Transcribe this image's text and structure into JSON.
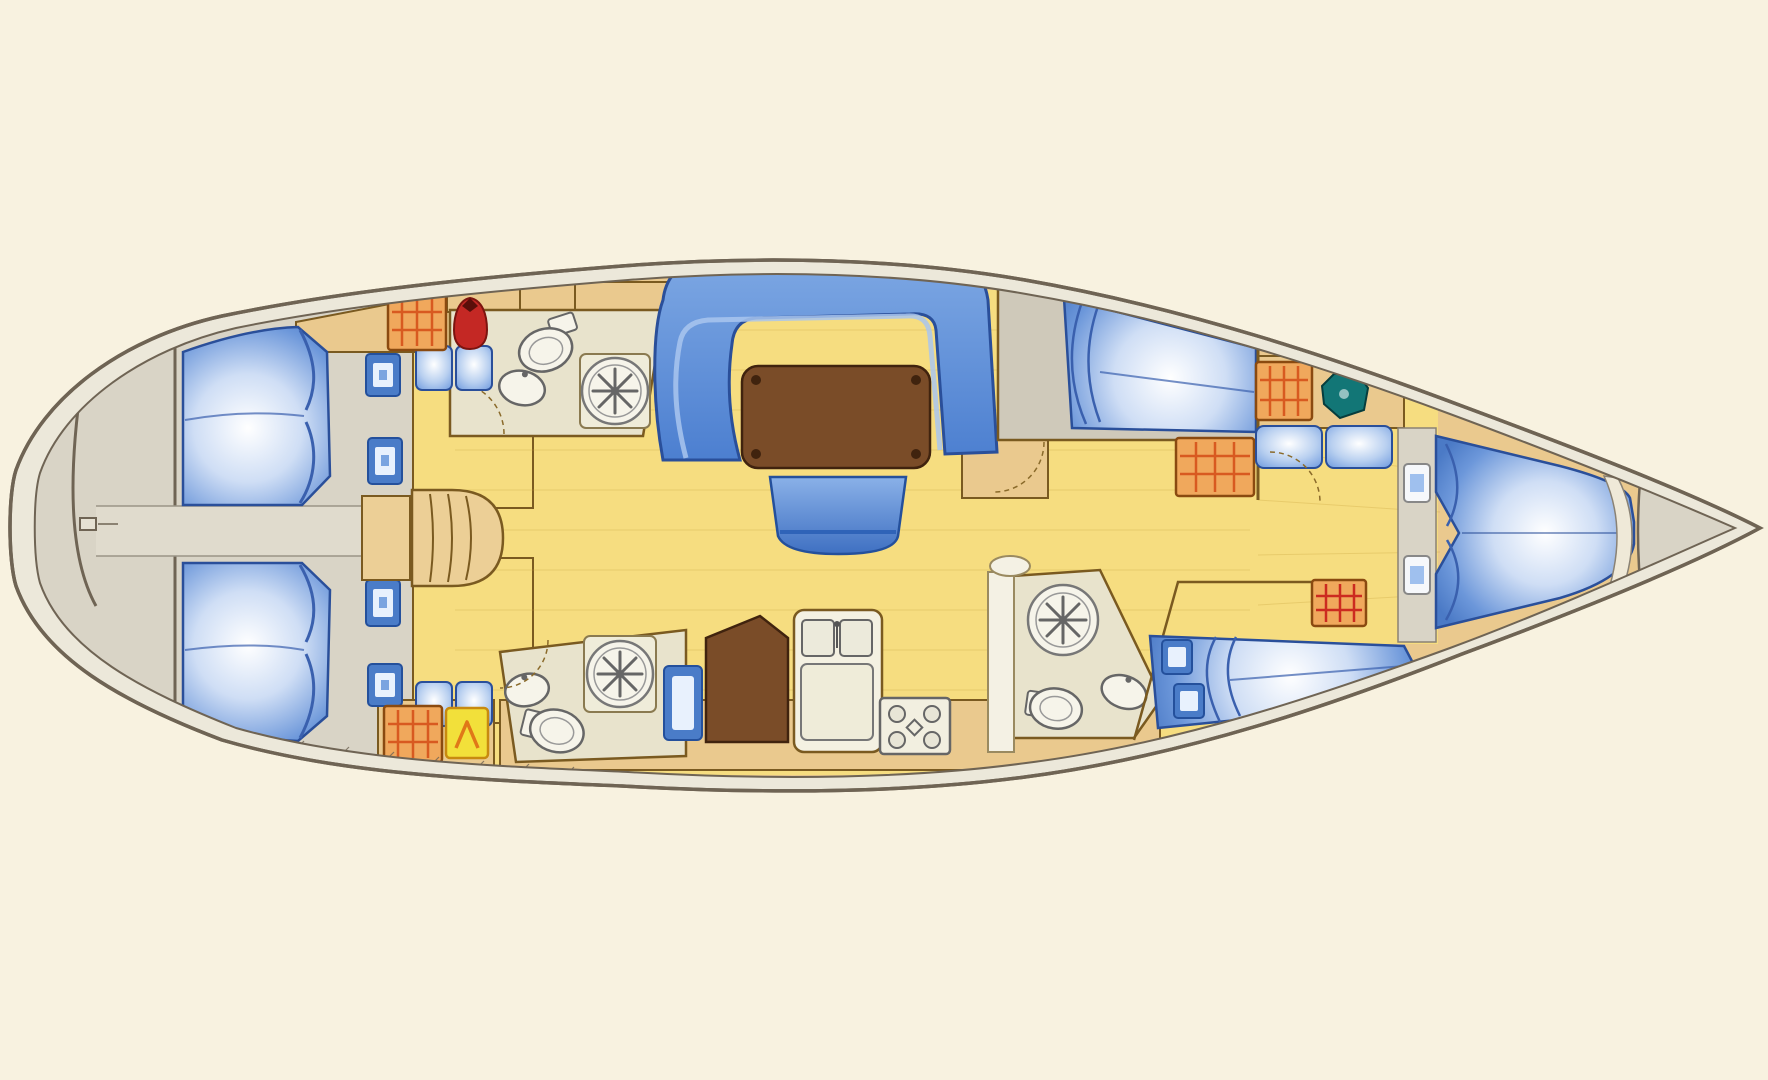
{
  "meta": {
    "alt": "sailing-yacht-interior-floor-plan",
    "orientation_bow": "right",
    "orientation_stern": "left"
  },
  "palette": {
    "background": "#f8f2e0",
    "hull_line": "#6f6454",
    "hull_band": "#ece8da",
    "deck_gray": "#d9d4c6",
    "cabin_gray": "#cfc9ba",
    "corridor_gray": "#e0dbcd",
    "floor_yellow": "#f6dd80",
    "floor_grain": "#c8a23c",
    "wood_tan": "#eac98e",
    "wood_line": "#7a5a20",
    "steps_tan": "#eccf96",
    "head_floor": "#e8e3cc",
    "fixture_white": "#f6f4ea",
    "fixture_line": "#6a665a",
    "berth_blue": "#5f8fd9",
    "berth_line": "#2a4f9a",
    "settee_blue": "#5a92dd",
    "table_brown": "#7a4c28",
    "table_line": "#40230e",
    "window_frame_blue": "#4a7cc8",
    "window_pane": "#e8f1fd",
    "wardrobe_orange": "#f0a85c",
    "wardrobe_stripe": "#d85a20",
    "jacket_red": "#c42824",
    "locker_yellow": "#f2e03a",
    "locker_yellow_mark": "#e07818",
    "sink_teal": "#127676",
    "divider_white": "#f4f1e4"
  },
  "rooms": [
    {
      "name": "swim-platform-stern",
      "features": [
        "transom-arc",
        "lazarette-hatch"
      ]
    },
    {
      "name": "aft-cabin-port",
      "features": [
        "double-berth",
        "hull-window",
        "hull-window",
        "seat-cushions",
        "wardrobe",
        "jacket-locker"
      ]
    },
    {
      "name": "aft-cabin-starboard",
      "features": [
        "double-berth",
        "hull-window",
        "hull-window",
        "seat-cushions",
        "wardrobe",
        "gear-locker"
      ]
    },
    {
      "name": "engine-corridor",
      "features": [
        "access-hatch"
      ]
    },
    {
      "name": "companionway",
      "features": [
        "steps"
      ]
    },
    {
      "name": "head-aft-port",
      "features": [
        "toilet",
        "washbasin",
        "shower"
      ]
    },
    {
      "name": "head-aft-starboard",
      "features": [
        "toilet",
        "washbasin",
        "shower"
      ]
    },
    {
      "name": "salon",
      "features": [
        "u-settee",
        "dining-table",
        "stool"
      ]
    },
    {
      "name": "galley",
      "features": [
        "fridge-front",
        "icebox",
        "double-sink",
        "worktop",
        "stove"
      ]
    },
    {
      "name": "head-forward-starboard",
      "features": [
        "shower",
        "toilet",
        "washbasin",
        "door"
      ]
    },
    {
      "name": "guest-cabin-port",
      "features": [
        "double-berth",
        "wardrobe",
        "cabinet"
      ]
    },
    {
      "name": "guest-cabin-starboard",
      "features": [
        "double-berth",
        "wardrobe",
        "hull-window",
        "hull-window"
      ]
    },
    {
      "name": "owner-cabin-bow",
      "features": [
        "v-berth",
        "wardrobe",
        "washbasin",
        "seat-lockers",
        "hull-window",
        "hull-window",
        "footboard"
      ]
    },
    {
      "name": "anchor-locker",
      "features": []
    }
  ]
}
